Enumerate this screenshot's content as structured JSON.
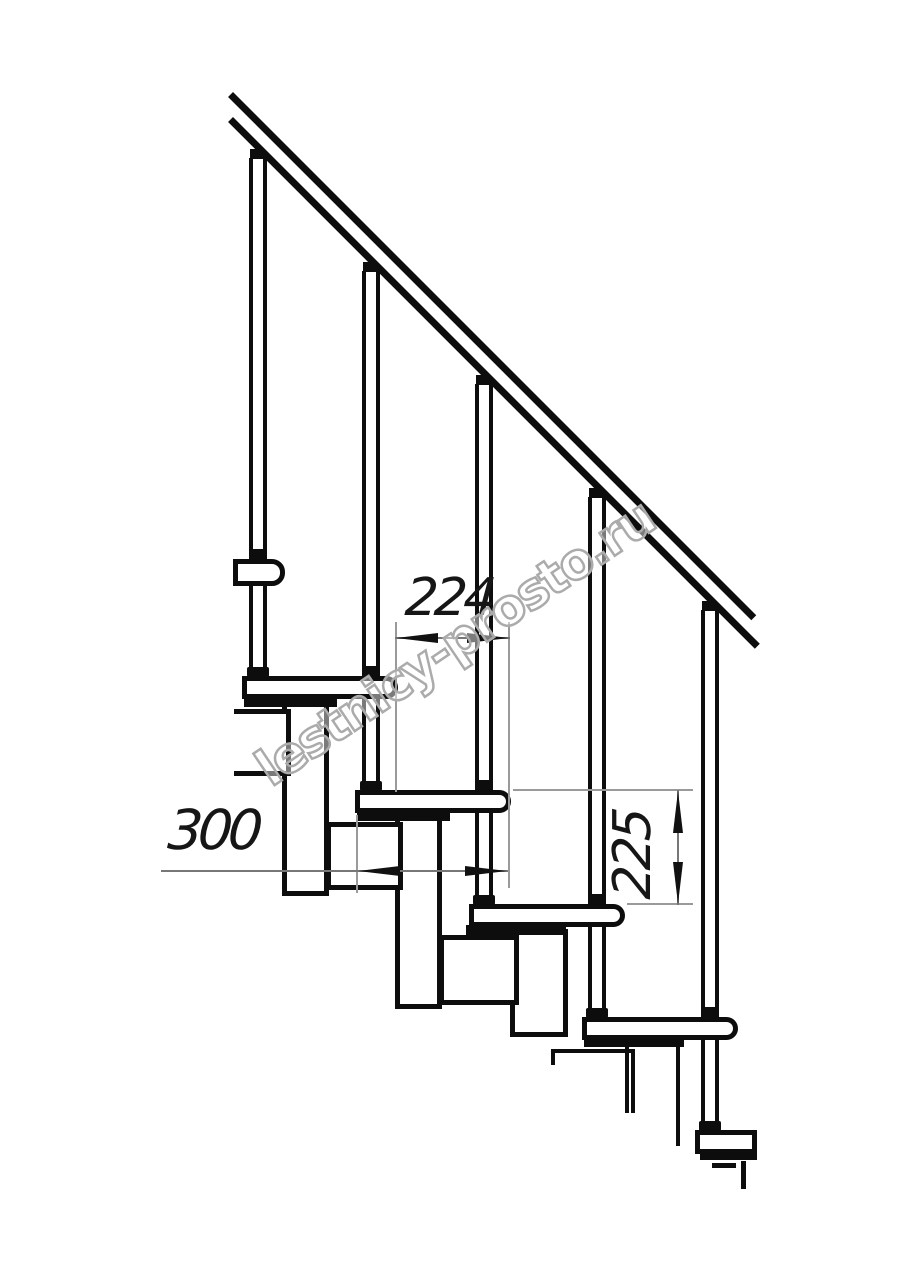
{
  "drawing": {
    "title": "modular staircase side elevation",
    "background_color": "#ffffff",
    "line_color": "#0d0d0d",
    "thin_line_color": "#9a9a9a",
    "handrail_angle_deg": 45,
    "balusters_count": 5,
    "treads_count": 6
  },
  "dimensions": {
    "run": {
      "value": "224",
      "orientation": "horizontal",
      "meaning": "tread offset"
    },
    "depth": {
      "value": "300",
      "orientation": "horizontal",
      "meaning": "tread depth"
    },
    "rise": {
      "value": "225",
      "orientation": "vertical",
      "meaning": "step rise"
    }
  },
  "watermark": {
    "text": "lestnicy-prosto.ru",
    "color": "#ababab"
  }
}
